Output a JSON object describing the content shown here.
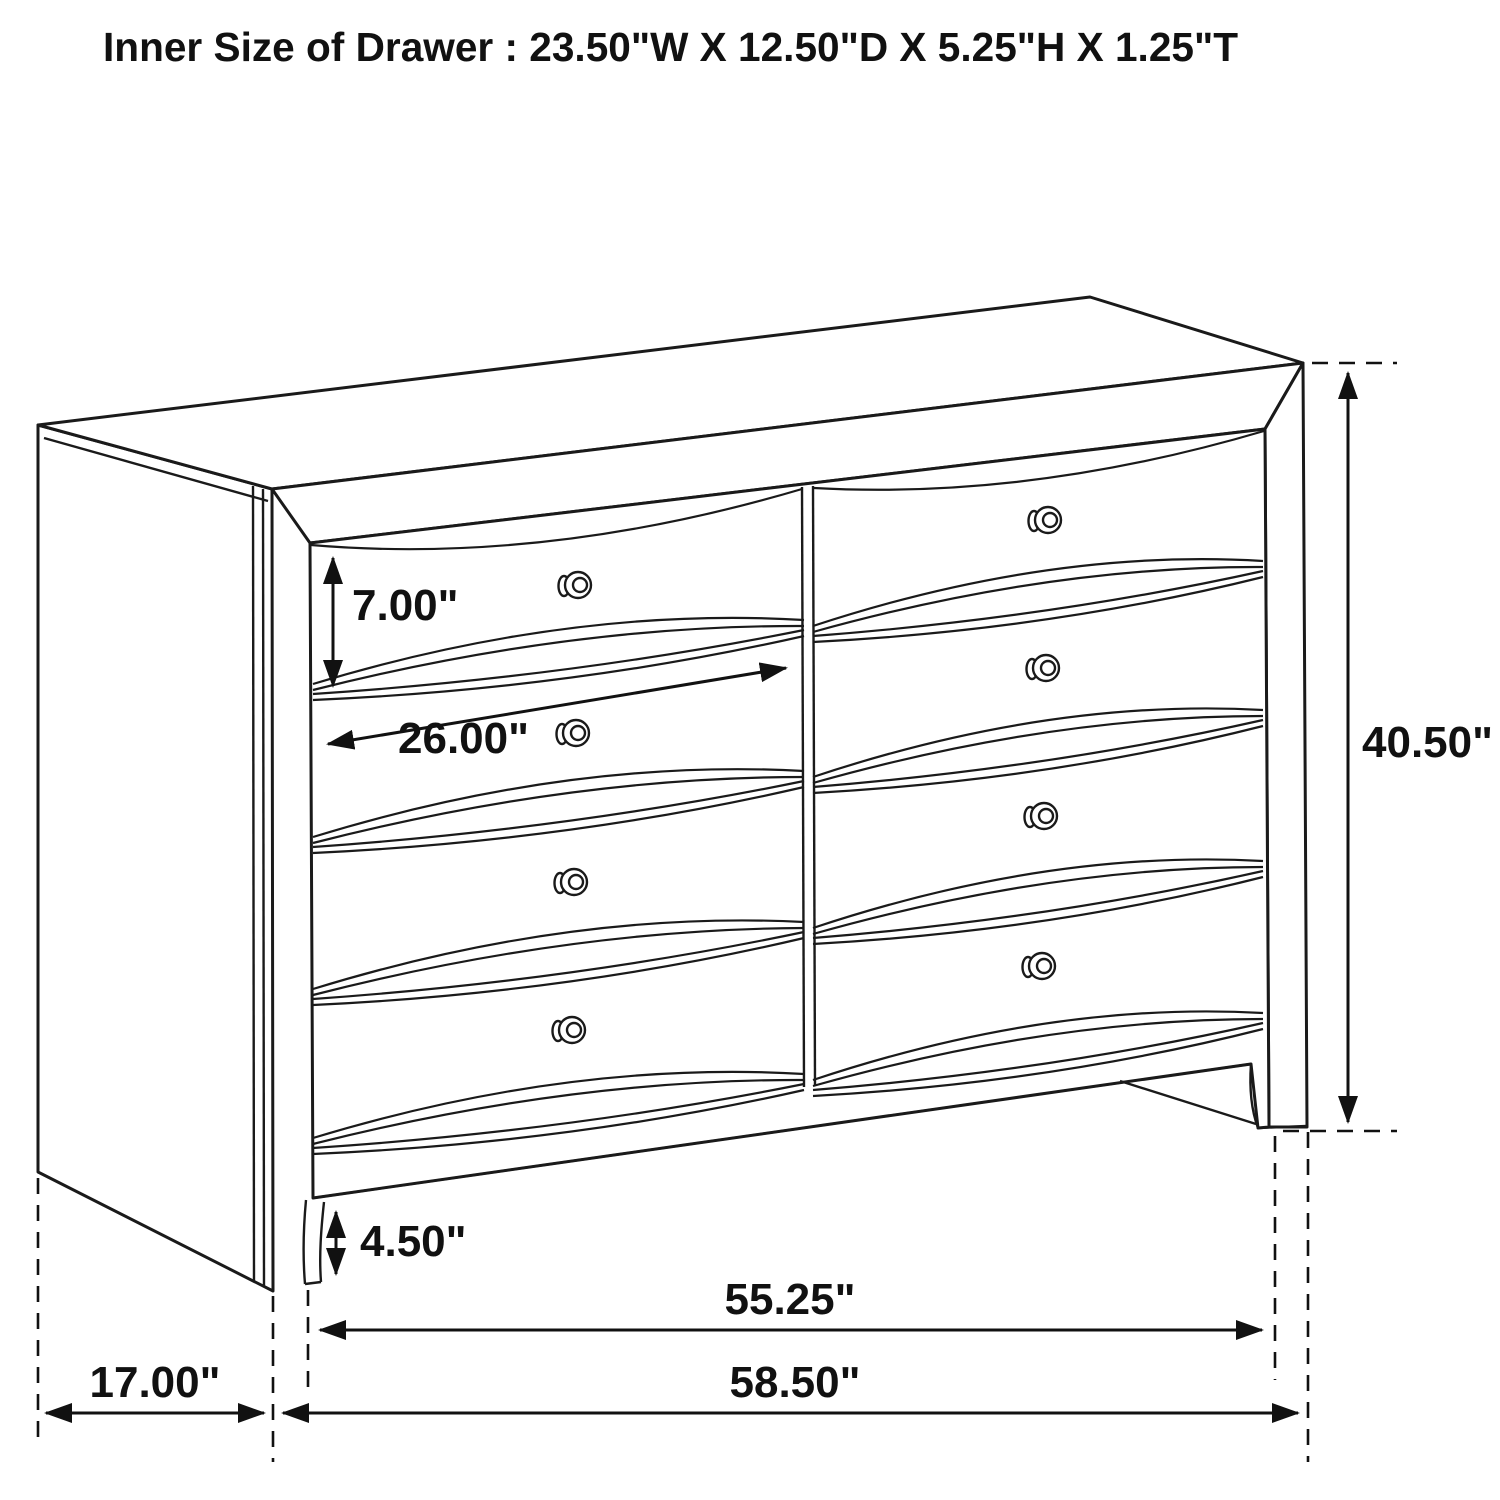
{
  "title": "Inner Size of Drawer : 23.50\"W X 12.50\"D X 5.25\"H X 1.25\"T",
  "inner_drawer_size": {
    "width": "23.50\"W",
    "depth": "12.50\"D",
    "height": "5.25\"H",
    "thickness": "1.25\"T"
  },
  "figure": {
    "subject": "eight-drawer dresser",
    "view": "front-left perspective technical line drawing",
    "drawer_columns": 2,
    "drawer_rows": 4,
    "knob_count": 8,
    "line_color": "#1a1a1a",
    "background_color": "#ffffff"
  },
  "dimensions": {
    "drawer_face_height": "7.00\"",
    "drawer_width": "26.00\"",
    "overall_height": "40.50\"",
    "foot_height": "4.50\"",
    "front_width": "55.25\"",
    "overall_width": "58.50\"",
    "side_depth": "17.00\""
  }
}
